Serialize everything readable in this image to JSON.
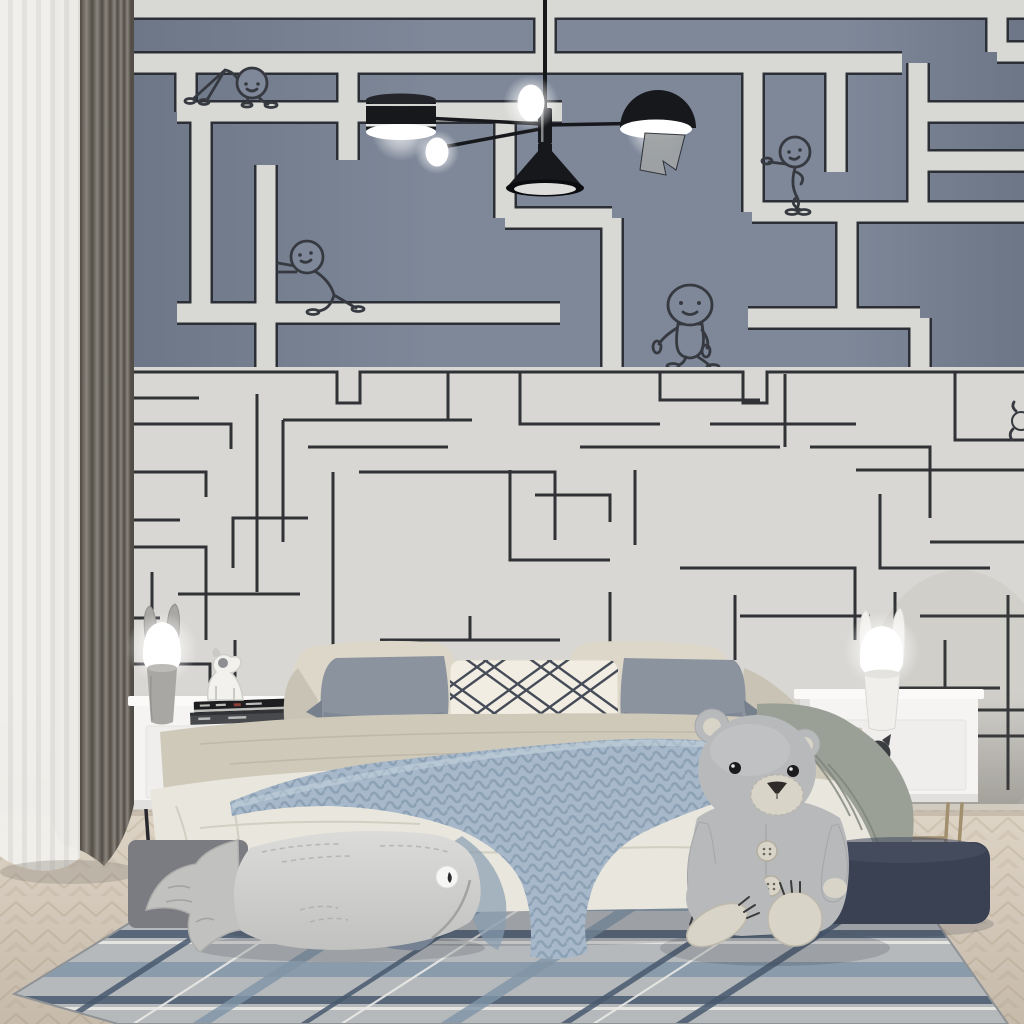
{
  "scene": {
    "label": "Kids bedroom with maze wallpaper mural, bed, teddy bear and plaid rug"
  },
  "objects": {
    "wallpaper_upper": "blue-gray maze wallpaper with white corridors and stick-figure characters",
    "wallpaper_lower": "white wainscot wall with thin dark maze lines",
    "character_crawling": "stick figure crawling on maze path",
    "character_pushing": "stick figure pushing maze wall",
    "character_walking": "round-headed figure walking along maze edge",
    "character_leaning": "stick figure leaning on maze wall",
    "character_peeking": "tiny figure peeking at right edge",
    "chandelier": "black mid-century chandelier with drum, cone, dome shades and glowing bulbs",
    "curtains": "gray blackout curtain with white sheer",
    "nightstand_left": "white nightstand with cat-face cutout handle and black metal legs",
    "nightstand_right": "white nightstand with cat-face cutout handle and brass legs",
    "lamp_left": "gray bunny-ear table lamp, lit",
    "lamp_right": "white bunny-ear table lamp, lit",
    "books": "two stacked books",
    "dog_figurine": "white dog figurine on books",
    "bed": "bed with beige quilt and cream duvet",
    "pillows": "cream, gray and lattice-pattern pillows",
    "knit_throw": "chunky knitted blue-gray throw blanket",
    "sage_blanket": "sage-gray blanket draped over bed corner",
    "teddy_bear": "large gray teddy bear with cream muzzle and buttons",
    "pouf": "dark navy pouf",
    "whale_cushion": "gray whale-shaped floor cushion",
    "cushion_blue": "small blue-gray cushion",
    "rug": "gray plaid rug with navy stripes",
    "floor": "light herringbone wood floor"
  },
  "colors": {
    "wall_upper": "#7e8899",
    "wall_upper_edge": "#6c7686",
    "maze_path": "#d8d8d5",
    "maze_outline": "#2c3036",
    "wall_lower": "#d9d7d3",
    "wall_lower_shadow": "#b8b5b0",
    "maze_line": "#303236",
    "character_line": "#363a40",
    "curtain_gray": "#8a857c",
    "curtain_gray_dark": "#524e47",
    "curtain_gray_light": "#a9a49a",
    "curtain_sheer": "#f1f0ec",
    "curtain_sheer_stripe": "#e3e2de",
    "chandelier_black": "#17181c",
    "chandelier_gray": "#9fa3a4",
    "glow": "#ffffff",
    "floor_light": "#ded4c6",
    "floor_dark": "#c6baaa",
    "floor_line": "#8c7356",
    "rug_base": "#b6b9bb",
    "rug_navy": "#48596e",
    "rug_blue": "#8095a8",
    "rug_white": "#e9e9e6",
    "rug_edge": "#8f9396",
    "nightstand_white": "#f5f4f2",
    "nightstand_shade": "#e1e0de",
    "nightstand_top": "#fbfaf8",
    "drawer_white": "#efeeec",
    "handle_dark": "#3b3d41",
    "leg_black": "#28282c",
    "leg_brass": "#a18f6e",
    "lamp_gray_body": "#a9a7a4",
    "lamp_gray_dark": "#8f8d8a",
    "lamp_white_body": "#f0efec",
    "lamp_white_dark": "#d9d8d4",
    "book_black": "#1e1e21",
    "book_gray": "#47494d",
    "book_pages": "#cfcfcb",
    "book_accent": "#8c3f38",
    "pillow_cream": "#dcd7c8",
    "pillow_cream_dark": "#c8c3b4",
    "pillow_gray": "#8b939e",
    "pillow_gray_dark": "#76808c",
    "pillow_white": "#f1ede2",
    "lattice_navy": "#454c58",
    "quilt_beige": "#cfc9ba",
    "quilt_line": "#bbb5a6",
    "duvet_cream": "#e9e6dd",
    "duvet_fold": "#cdc9bd",
    "throw_blue": "#a6b8c9",
    "throw_dark": "#879db1",
    "throw_light": "#c7d5e0",
    "sage": "#9aa095",
    "sage_dark": "#7e847a",
    "whale_light": "#dbdbd9",
    "whale_mid": "#c1c1bf",
    "whale_line": "#a2a2a0",
    "whale_base": "#7b7b82",
    "eye_white": "#f6f6f4",
    "pupil": "#2c2c2e",
    "cushion_blue": "#8794a6",
    "cushion_blue_dark": "#707f93",
    "pouf": "#3a4152",
    "pouf_light": "#4b5265",
    "bear_body": "#b7b9bb",
    "bear_light": "#c9cbcc",
    "bear_shade": "#9da0a2",
    "bear_cream": "#d8d4c7",
    "bear_nose": "#2e2b28",
    "dog_white": "#f2f1ed",
    "dog_shade": "#c9c9c5",
    "dog_dark": "#6b6e74",
    "shadow_soft": "rgba(45,50,60,0.18)"
  }
}
